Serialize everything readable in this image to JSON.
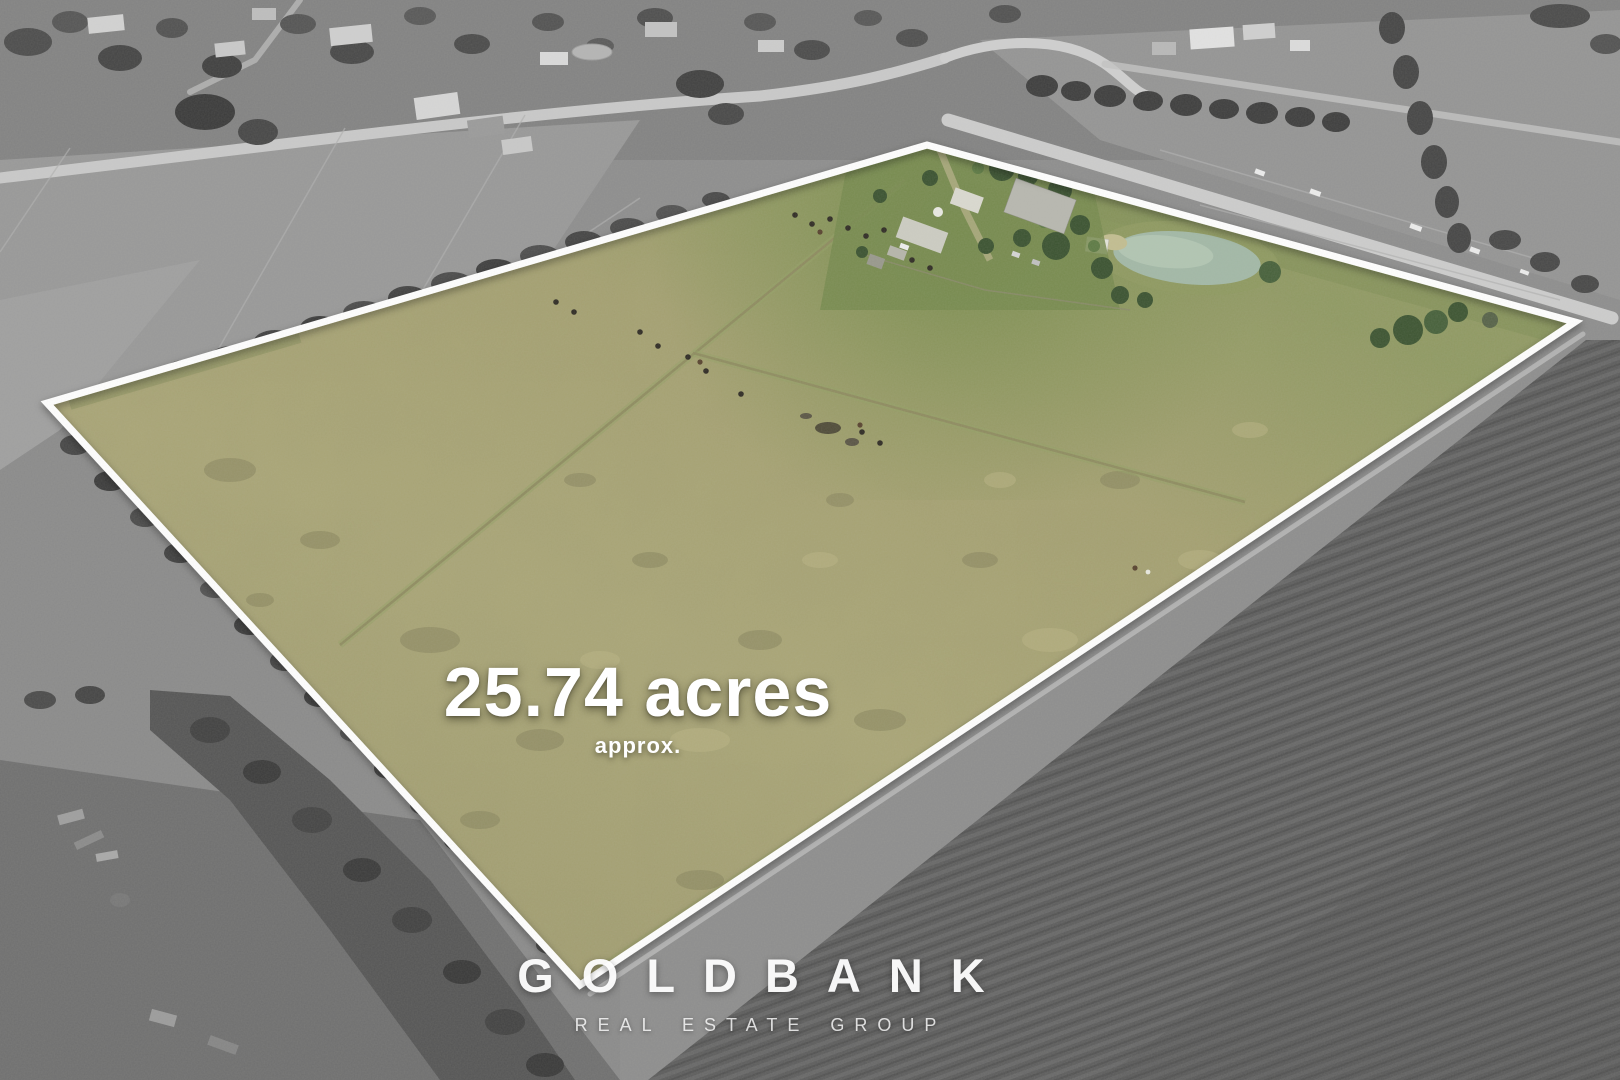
{
  "overlay": {
    "area_value": "25.74 acres",
    "area_qualifier": "approx."
  },
  "branding": {
    "name": "GOLDBANK",
    "tagline": "REAL ESTATE GROUP"
  },
  "colors": {
    "boundary_line": "#ffffff",
    "pasture_highlight": "#a5a171",
    "overlay_text": "#ffffff",
    "surroundings_grayscale": "#8d8d8d",
    "plowed_field": "#5c5c5c",
    "dam_water": "#a2b8a6"
  }
}
